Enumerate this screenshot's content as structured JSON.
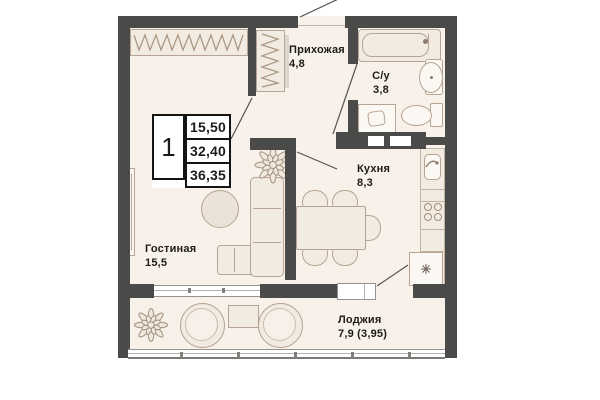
{
  "title": "Floor plan — 1-room apartment",
  "info_box": {
    "room_count": "1",
    "values": [
      "15,50",
      "32,40",
      "36,35"
    ]
  },
  "rooms": {
    "hallway": {
      "name": "Прихожая",
      "area": "4,8"
    },
    "bathroom": {
      "name": "С/у",
      "area": "3,8"
    },
    "kitchen": {
      "name": "Кухня",
      "area": "8,3"
    },
    "living": {
      "name": "Гостиная",
      "area": "15,5"
    },
    "loggia": {
      "name": "Лоджия",
      "area": "7,9 (3,95)"
    }
  },
  "icons": {
    "freezer_symbol": "✳",
    "plant_symbol": "❁",
    "hanger_rail_symbol": "zigzag"
  },
  "colors": {
    "wall": "#4a4a48",
    "floor": "#f7f1e9",
    "furn_fill": "#f2ebe1",
    "furn_stroke": "#b7a493",
    "counter_stroke": "#c2b2a2",
    "glass_line": "#95938f",
    "text": "#1d1c1a",
    "line": "#55544e",
    "box_border": "#141414",
    "white": "#ffffff"
  }
}
